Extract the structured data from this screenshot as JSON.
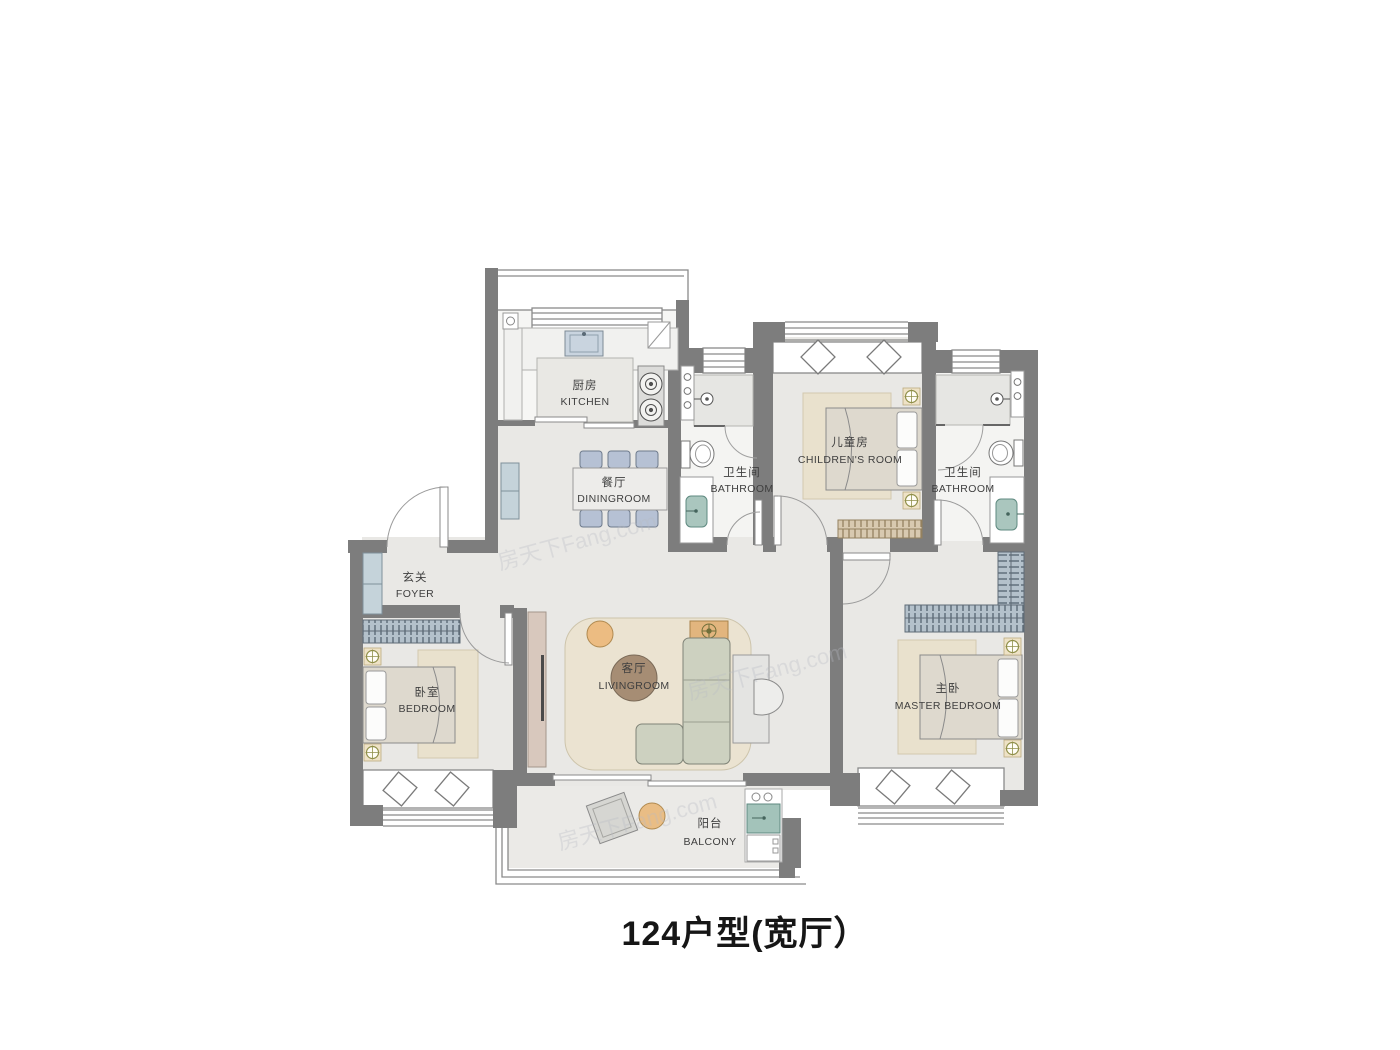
{
  "title": "124户型(宽厅）",
  "watermark": "房天下Fang.com",
  "colors": {
    "wall": "#7d7d7d",
    "floor": "#e9e8e5",
    "bathroom_floor": "#f4f4f2",
    "kitchen_floor": "#f6f6f4",
    "rug": "#e9e1cd",
    "bed_fabric": "#ded9ce",
    "chair_blue": "#b6c1d4",
    "cabinet_blue": "#c5d3da",
    "wardrobe_blue": "#b4c1cb",
    "wardrobe_tan": "#d8c9b0",
    "tv_panel": "#d8c8bd",
    "sofa": "#cdd1c0",
    "coffee_table": "#a68d74",
    "wood_accent": "#e9bd85",
    "washer_teal": "#a3c3ba"
  },
  "rooms": {
    "kitchen": {
      "zh": "厨房",
      "en": "KITCHEN"
    },
    "dining": {
      "zh": "餐厅",
      "en": "DININGROOM"
    },
    "bathroom1": {
      "zh": "卫生间",
      "en": "BATHROOM"
    },
    "children": {
      "zh": "儿童房",
      "en": "CHILDREN'S ROOM"
    },
    "bathroom2": {
      "zh": "卫生间",
      "en": "BATHROOM"
    },
    "foyer": {
      "zh": "玄关",
      "en": "FOYER"
    },
    "bedroom": {
      "zh": "卧室",
      "en": "BEDROOM"
    },
    "living": {
      "zh": "客厅",
      "en": "LIVINGROOM"
    },
    "master": {
      "zh": "主卧",
      "en": "MASTER BEDROOM"
    },
    "balcony": {
      "zh": "阳台",
      "en": "BALCONY"
    }
  }
}
